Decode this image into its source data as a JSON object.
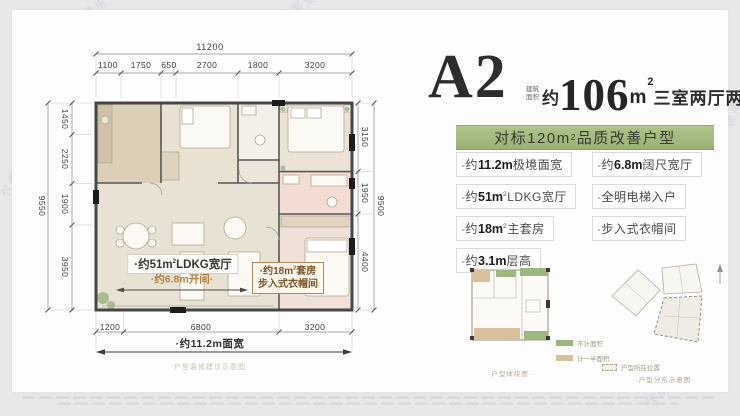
{
  "watermark": {
    "text": "仅供内部使用"
  },
  "header": {
    "unit": "A2",
    "area_note_line1": "建筑",
    "area_note_line2": "面积",
    "area_prefix": "约",
    "area_value": "106",
    "area_unit": "m",
    "area_sup": "2",
    "rooms": "三室两厅两卫"
  },
  "banner": {
    "pre": "对标120m",
    "sup": "2",
    "rest": "品质改善户型"
  },
  "features": [
    {
      "pre": "·约",
      "num": "11.2m",
      "sup": "",
      "rest": "极境面宽"
    },
    {
      "pre": "·约",
      "num": "51m",
      "sup": "2",
      "rest": "LDKG宽厅"
    },
    {
      "pre": "·约",
      "num": "18m",
      "sup": "2",
      "rest": "主套房"
    },
    {
      "pre": "·约",
      "num": "3.1m",
      "sup": "",
      "rest": "层高"
    },
    {
      "pre": "·约",
      "num": "6.8m",
      "sup": "",
      "rest": "阔尺宽厅"
    },
    {
      "pre": "·",
      "num": "",
      "sup": "",
      "rest": "全明电梯入户"
    },
    {
      "pre": "·",
      "num": "",
      "sup": "",
      "rest": "步入式衣帽间"
    }
  ],
  "plan": {
    "dims": {
      "top_total": "11200",
      "top_segments": [
        "1100",
        "1750",
        "650",
        "2700",
        "1800",
        "3200"
      ],
      "left_total": "9550",
      "left_segments": [
        "1450",
        "2250",
        "1900",
        "3950"
      ],
      "right_total": "9500",
      "right_segments": [
        "3150",
        "1950",
        "4400"
      ],
      "bottom_segments": [
        "1200",
        "6800",
        "3200"
      ],
      "bottom_total_label": "·约11.2m面宽"
    },
    "labels": {
      "ldkg_pre": "·约51m",
      "ldkg_sup": "2",
      "ldkg_rest": "LDKG宽厅",
      "kaijian": "·约6.8m开间·",
      "suite_pre": "·约18m",
      "suite_sup": "2",
      "suite_rest": "套房",
      "suite_line2": "步入式衣帽间"
    },
    "caption": "·户型装修建议示意图·"
  },
  "thumbs": {
    "left_caption": "·户型体块图·",
    "legend": [
      {
        "label": "不计面积"
      },
      {
        "label": "计一半面积"
      }
    ],
    "location_label": "户型所在位置",
    "right_caption": "·户型分布示意图·"
  },
  "colors": {
    "banner_green": "#a3ba7e",
    "wall_dark": "#474747",
    "bath_pink": "#f3dcd4",
    "kitchen_tan": "#dccfb8",
    "plant_green": "#a4b98b",
    "legend_green": "#9cb87e",
    "legend_tan": "#d9bf9b"
  }
}
